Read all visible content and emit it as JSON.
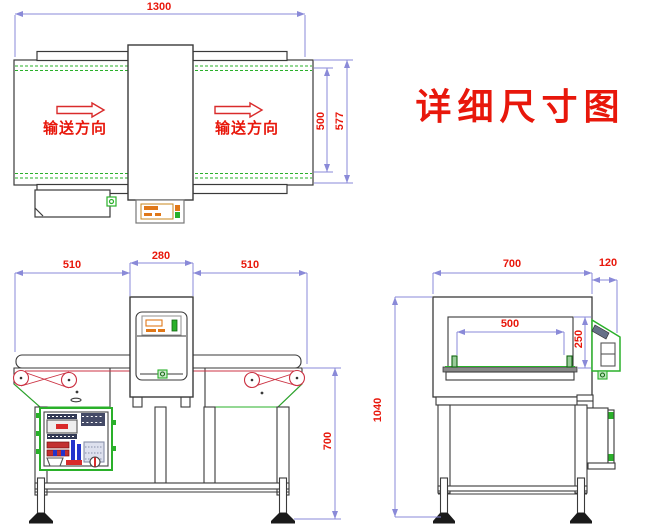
{
  "title": {
    "text": "详细尺寸图"
  },
  "colors": {
    "dimension_line": "#8a8ad8",
    "dimension_text": "#e8170b",
    "drawing_outline": "#3a3a3a",
    "accent_green": "#2ab02a",
    "accent_orange": "#e07818",
    "accent_red": "#d92b2b"
  },
  "top_view": {
    "dim_length": "1300",
    "dim_belt_width": "500",
    "dim_overall_width": "577",
    "direction_label_left": "输送方向",
    "direction_label_right": "输送方向"
  },
  "front_view": {
    "dim_infeed": "510",
    "dim_detector_width": "280",
    "dim_outfeed": "510",
    "dim_belt_height": "700"
  },
  "side_view": {
    "dim_depth": "700",
    "dim_panel_depth": "120",
    "dim_aperture_width": "500",
    "dim_aperture_height": "250",
    "dim_total_height": "1040"
  }
}
